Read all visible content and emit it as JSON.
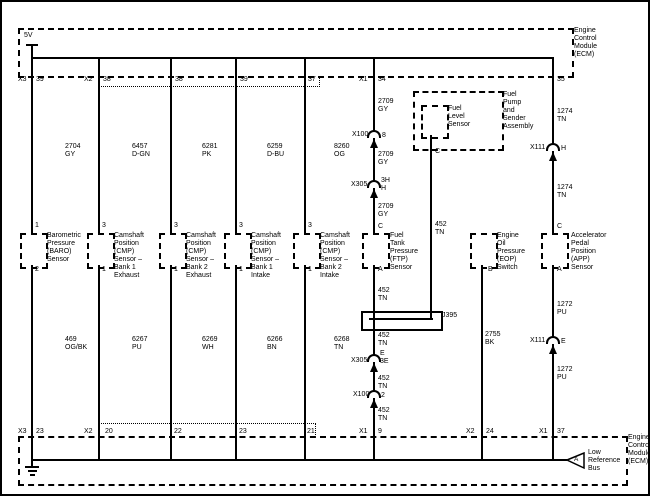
{
  "supply_label": "5V",
  "ecm_top": {
    "name": "Engine\nControl\nModule\n(ECM)"
  },
  "ecm_bottom": {
    "name": "Engine\nControl\nModule\n(ECM)",
    "bus_tag": "A",
    "bus_label": "Low\nReference\nBus"
  },
  "top_pins": [
    {
      "conn": "X3",
      "pin": "39"
    },
    {
      "conn": "X2",
      "pin": "38"
    },
    {
      "pin": "38"
    },
    {
      "pin": "39"
    },
    {
      "pin": "37"
    },
    {
      "conn": "X1",
      "pin": "34"
    },
    {
      "pin": "35"
    }
  ],
  "bottom_pins": [
    {
      "conn": "X3",
      "pin": "23"
    },
    {
      "conn": "X2",
      "pin": "20"
    },
    {
      "pin": "22"
    },
    {
      "pin": "23"
    },
    {
      "pin": "21"
    },
    {
      "conn": "X1",
      "pin": "9"
    },
    {
      "conn": "X2",
      "pin": "24"
    },
    {
      "conn": "X1",
      "pin": "37"
    }
  ],
  "sensors": [
    {
      "name": "Barometric\nPressure\n(BARO)\nSensor",
      "pin_top": "1",
      "pin_bottom": "2",
      "wire_top": "2704\nGY",
      "wire_bottom": "469\nOG/BK"
    },
    {
      "name": "Camshaft\nPosition\n(CMP)\nSensor –\nBank 1\nExhaust",
      "pin_top": "3",
      "pin_bottom": "1",
      "wire_top": "6457\nD-GN",
      "wire_bottom": "6267\nPU"
    },
    {
      "name": "Camshaft\nPosition\n(CMP)\nSensor –\nBank 2\nExhaust",
      "pin_top": "3",
      "pin_bottom": "1",
      "wire_top": "6281\nPK",
      "wire_bottom": "6269\nWH"
    },
    {
      "name": "Camshaft\nPosition\n(CMP)\nSensor –\nBank 1\nIntake",
      "pin_top": "3",
      "pin_bottom": "1",
      "wire_top": "6259\nD-BU",
      "wire_bottom": "6266\nBN"
    },
    {
      "name": "Camshaft\nPosition\n(CMP)\nSensor –\nBank 2\nIntake",
      "pin_top": "3",
      "pin_bottom": "1",
      "wire_top": "8260\nOG",
      "wire_bottom": "6268\nTN"
    }
  ],
  "ftp": {
    "name": "Fuel\nTank\nPressure\n(FTP)\nSensor",
    "pin_top": "C",
    "pin_bottom": "A",
    "wire_upper_1": "2709\nGY",
    "wire_upper_2": "2709\nGY",
    "wire_upper_3": "2709\nGY",
    "wire_above_splice": "452\nTN",
    "wire_below_1": "452\nTN",
    "wire_below_2": "452\nTN",
    "wire_below_3": "452\nTN",
    "conn_1": {
      "name": "X100",
      "pin": "8"
    },
    "conn_2": {
      "name": "X305",
      "pin": "3H\nH"
    },
    "conn_3": {
      "name": "X305",
      "pin": "E\n3E"
    },
    "conn_4": {
      "name": "X100",
      "pin": "2"
    },
    "splice": "J395"
  },
  "fuel_pump": {
    "assembly": "Fuel\nPump\nand\nSender\nAssembly",
    "sensor": "Fuel\nLevel\nSensor",
    "pin": "C",
    "wire": "452\nTN"
  },
  "eop": {
    "name": "Engine\nOil\nPressure\n(EOP)\nSwitch",
    "pin_bottom": "B",
    "wire": "2755\nBK"
  },
  "app": {
    "name": "Accelerator\nPedal\nPosition\n(APP)\nSensor",
    "pin_top": "C",
    "pin_bottom": "A",
    "wire_upper_1": "1274\nTN",
    "wire_upper_2": "1274\nTN",
    "wire_lower_1": "1272\nPU",
    "wire_lower_2": "1272\nPU",
    "conn_1": {
      "name": "X111",
      "pin": "H"
    },
    "conn_2": {
      "name": "X111",
      "pin": "E"
    }
  },
  "colors": {
    "line": "#000000",
    "background": "#ffffff"
  }
}
